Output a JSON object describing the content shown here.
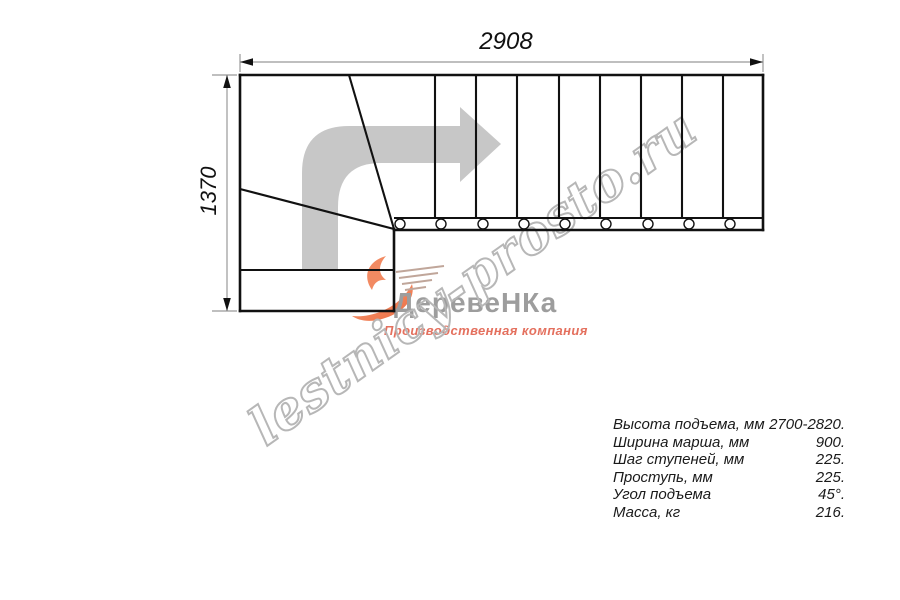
{
  "page": {
    "background": "#ffffff"
  },
  "dims": {
    "top": "2908",
    "left": "1370"
  },
  "drawing": {
    "type": "L-shaped staircase plan, top view",
    "straight_treads": 9,
    "winder_treads": 3,
    "baluster_count": 9,
    "turn_arrow": "direction-of-travel, 90-degree turn from bottom landing to the right"
  },
  "watermark": {
    "text": "lestnicy-prosto.ru"
  },
  "logo": {
    "brand": "ДеревеНКа",
    "tagline": "Производственная компания",
    "flame_icon": "flame-swoosh-icon"
  },
  "specs": {
    "rows": [
      {
        "label": "Высота подъема, мм",
        "value": "2700-2820."
      },
      {
        "label": "Ширина марша, мм",
        "value": "900."
      },
      {
        "label": "Шаг ступеней, мм",
        "value": "225."
      },
      {
        "label": "Проступь, мм",
        "value": "225."
      },
      {
        "label": "Угол подъема",
        "value": "45°."
      },
      {
        "label": "Масса, кг",
        "value": "216."
      }
    ]
  },
  "colors": {
    "line": "#111111",
    "dimension_line": "#999999",
    "direction_arrow": "#c7c7c7",
    "watermark_stroke": "#b7b7b7",
    "logo_text": "#9d9d9d",
    "logo_accent": "#e4705e",
    "flame": "#ef805a"
  }
}
